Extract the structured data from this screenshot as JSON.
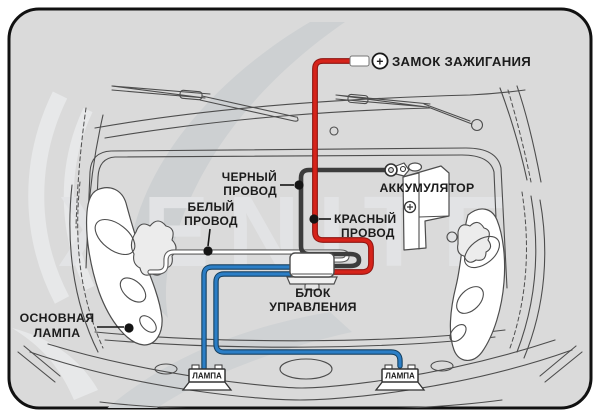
{
  "watermark": {
    "text": "XENITE"
  },
  "labels": {
    "ignition_lock": "ЗАМОК ЗАЖИГАНИЯ",
    "ignition_plus": "+",
    "battery": "АККУМУЛЯТОР",
    "black_wire": {
      "line1": "ЧЕРНЫЙ",
      "line2": "ПРОВОД"
    },
    "white_wire": {
      "line1": "БЕЛЫЙ",
      "line2": "ПРОВОД"
    },
    "red_wire": {
      "line1": "КРАСНЫЙ",
      "line2": "ПРОВОД"
    },
    "control_unit": {
      "line1": "БЛОК",
      "line2": "УПРАВЛЕНИЯ"
    },
    "main_lamp": {
      "line1": "ОСНОВНАЯ",
      "line2": "ЛАМПА"
    },
    "left_lamp": "ЛАМПА",
    "right_lamp": "ЛАМПА"
  },
  "colors": {
    "background": "#dadada",
    "frame_border": "#111111",
    "red_wire": "#d6231a",
    "black_wire": "#3c3c3c",
    "white_wire": "#ffffff",
    "blue_wire": "#2b7ec6"
  }
}
